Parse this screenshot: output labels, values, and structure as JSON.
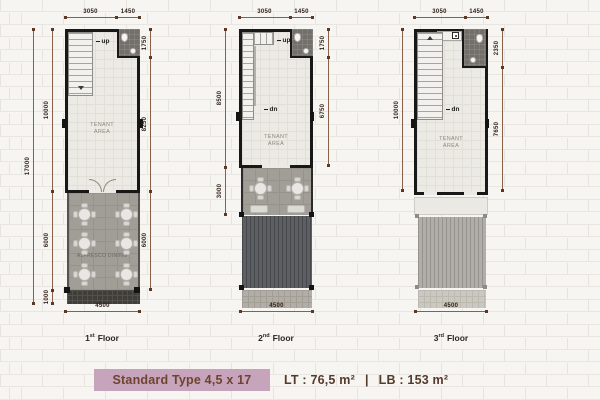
{
  "banner": {
    "type_label": "Standard Type 4,5 x 17",
    "lt": "LT : 76,5 m²",
    "divider": "|",
    "lb": "LB : 153 m²"
  },
  "plans": [
    {
      "id": "first-floor",
      "floor_label": {
        "number": "1",
        "ordinal": "st",
        "word": "Floor"
      },
      "dims": {
        "top": [
          "3050",
          "1450"
        ],
        "left_outer": "17000",
        "left": [
          "10000",
          "6000",
          "1000"
        ],
        "right": [
          "1750",
          "8250",
          "6000"
        ],
        "bottom": "4500"
      },
      "rooms": {
        "tenant": "TENANT AREA",
        "alfresco": "ALFRESCO DINING"
      },
      "stair_labels": {
        "up": "up"
      }
    },
    {
      "id": "second-floor",
      "floor_label": {
        "number": "2",
        "ordinal": "nd",
        "word": "Floor"
      },
      "dims": {
        "top": [
          "3050",
          "1450"
        ],
        "left": [
          "8500",
          "3000"
        ],
        "right": [
          "1750",
          "6750"
        ],
        "bottom": "4500"
      },
      "rooms": {
        "tenant": "TENANT AREA"
      },
      "stair_labels": {
        "up": "up",
        "dn": "dn"
      }
    },
    {
      "id": "third-floor",
      "floor_label": {
        "number": "3",
        "ordinal": "rd",
        "word": "Floor"
      },
      "dims": {
        "top": [
          "3050",
          "1450"
        ],
        "left": [
          "10000"
        ],
        "right": [
          "2350",
          "7650"
        ],
        "bottom": "4500"
      },
      "rooms": {
        "tenant": "TENANT AREA"
      },
      "stair_labels": {
        "dn": "dn"
      }
    }
  ],
  "colors": {
    "dimension_line": "#8a6148",
    "wall": "#181818",
    "banner_box": "#c6a4bb",
    "banner_text": "#6f4331",
    "floor2_roof": "#5c5f63",
    "floor3_roof": "#b1aea9"
  }
}
